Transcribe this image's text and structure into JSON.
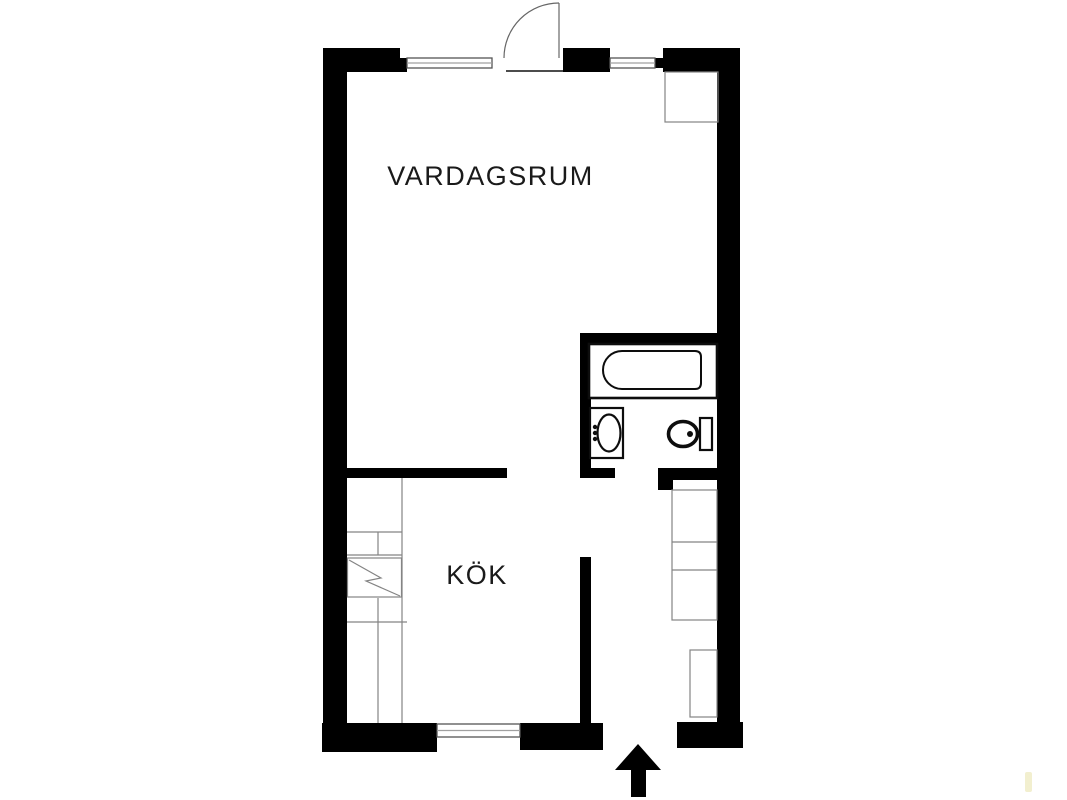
{
  "floorplan": {
    "type": "apartment-floor-plan",
    "rooms": [
      {
        "id": "living-room",
        "label": "VARDAGSRUM"
      },
      {
        "id": "kitchen",
        "label": "KÖK"
      }
    ],
    "colors": {
      "background": "#ffffff",
      "wall": "#000000",
      "fixture_outline": "#0d0d0d",
      "cabinet_outline": "#848484",
      "window_frame": "#555555",
      "window_mid": "#a0a0a0",
      "door_line": "#666666",
      "label_text": "#1a1a1a",
      "artifact": "#f2efcf"
    },
    "fixtures": [
      {
        "name": "bathtub"
      },
      {
        "name": "washbasin"
      },
      {
        "name": "toilet"
      },
      {
        "name": "stove"
      },
      {
        "name": "kitchen-counter"
      },
      {
        "name": "wardrobes"
      },
      {
        "name": "closet"
      },
      {
        "name": "entry-door-swing"
      },
      {
        "name": "entrance-arrow"
      },
      {
        "name": "windows"
      }
    ]
  }
}
